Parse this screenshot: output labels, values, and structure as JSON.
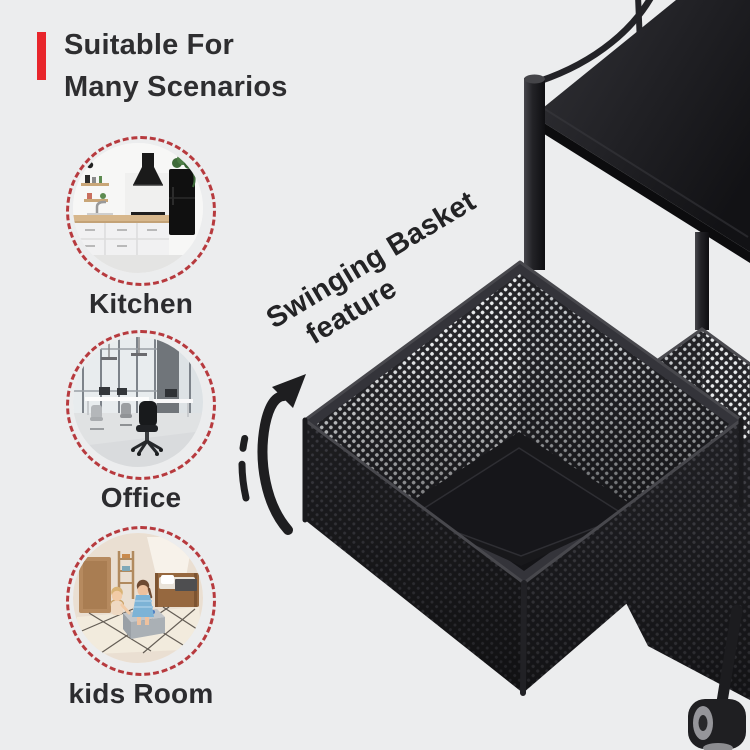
{
  "colors": {
    "background": "#ecedee",
    "accent_red": "#e8252b",
    "dashed_ring_red": "#b73a3e",
    "text_dark": "#2e2e30",
    "product_black": "#1d1d20",
    "mesh_dot_light": "#e9ebed"
  },
  "header": {
    "line1": "Suitable For",
    "line2": "Many Scenarios"
  },
  "scenarios": [
    {
      "label": "Kitchen"
    },
    {
      "label": "Office"
    },
    {
      "label": "kids Room"
    }
  ],
  "callout": {
    "line1": "Swinging Basket",
    "line2": "feature"
  }
}
